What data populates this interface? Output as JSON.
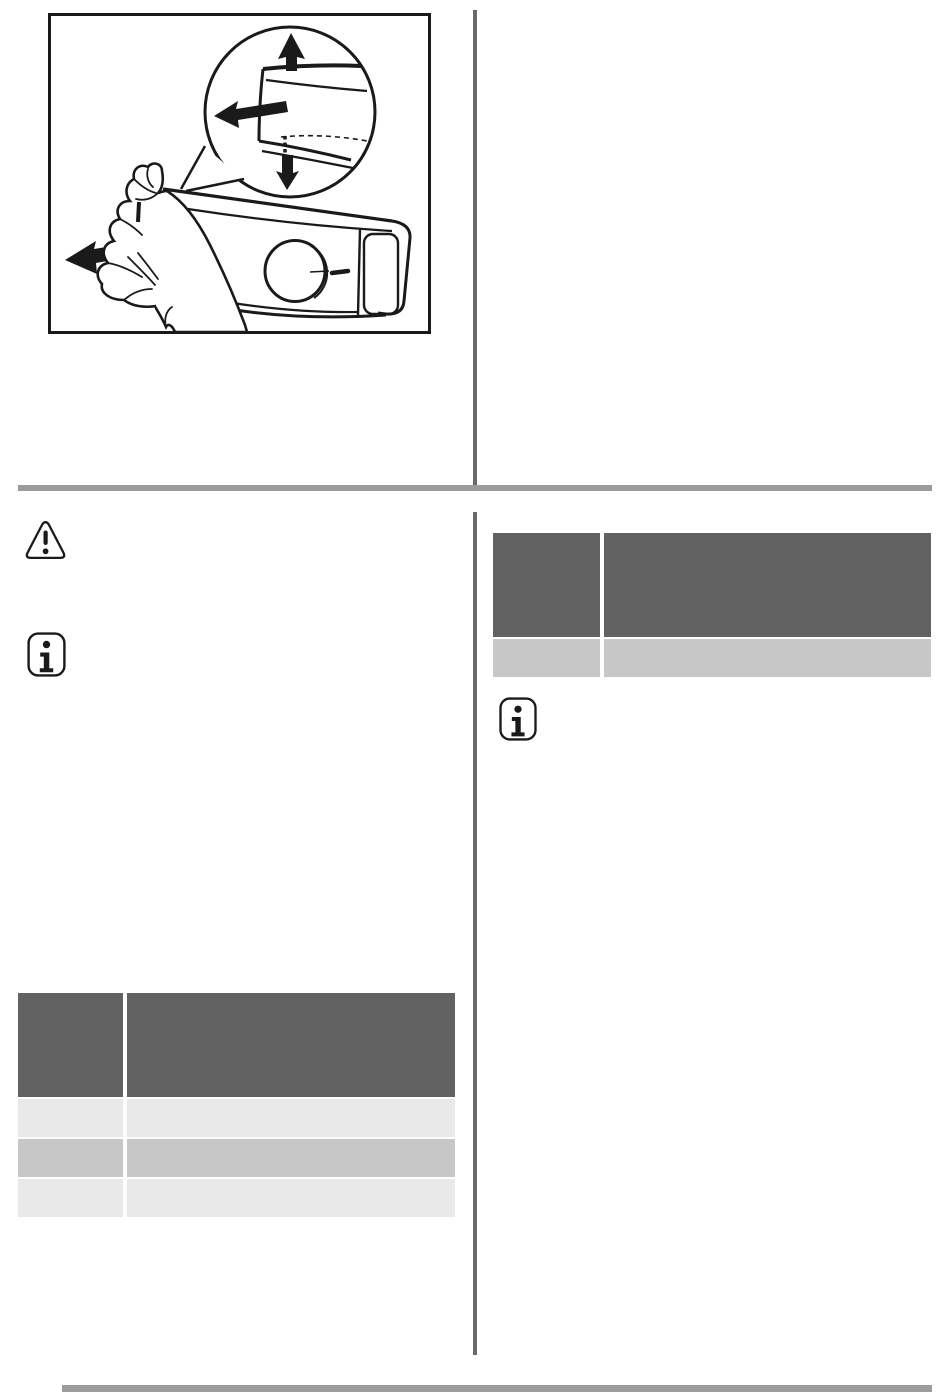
{
  "page": {
    "background": "#ffffff",
    "ink": "#1a1a1a",
    "colors": {
      "section_bar": "#9c9c9c",
      "footer_bar": "#9c9c9c",
      "column_divider": "#696969",
      "table_header": "#626262",
      "table_row_light": "#e9e9e9",
      "table_row_mid": "#c7c7c7"
    }
  },
  "figure": {
    "name": "hand-pulling-control-panel-drawer",
    "parts": [
      "magnifier-circle",
      "drawer-lip",
      "up-arrow",
      "left-arrow",
      "down-arrow",
      "control-panel",
      "selector-knob",
      "hand",
      "pull-direction-arrow"
    ]
  },
  "icons": {
    "warning": {
      "name": "warning-triangle-icon",
      "glyph": "!"
    },
    "info_left": {
      "name": "info-icon",
      "glyph": "i"
    },
    "info_right": {
      "name": "info-icon",
      "glyph": "i"
    }
  },
  "tables": {
    "left": {
      "header": [
        "",
        ""
      ],
      "rows": [
        [
          "",
          ""
        ],
        [
          "",
          ""
        ],
        [
          "",
          ""
        ]
      ]
    },
    "right": {
      "header": [
        "",
        ""
      ],
      "rows": [
        [
          "",
          ""
        ]
      ]
    }
  }
}
